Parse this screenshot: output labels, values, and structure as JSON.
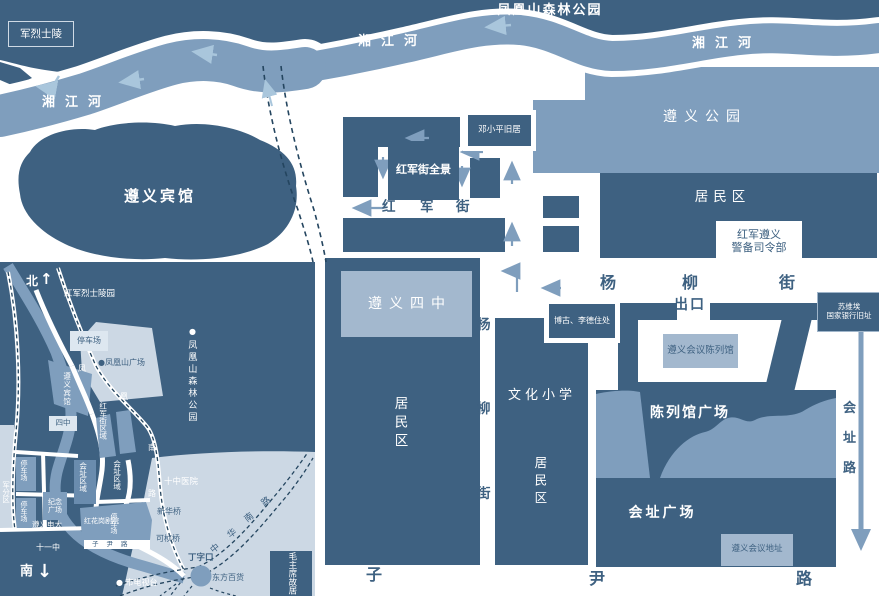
{
  "colors": {
    "dark": "#3e6181",
    "medium": "#7f9ebd",
    "pale": "#ccd8e4",
    "box_light": "#a3b8ce",
    "box_pale": "#dde7f0",
    "arrow_light": "#a9c6dc",
    "dash": "#24455f",
    "white": "#ffffff"
  },
  "main": {
    "park_title": "凤凰山森林公园",
    "martyrs_tomb": "军烈士陵",
    "river": "湘江河",
    "hotel": "遵义宾馆",
    "zunyi_park": "遵义公园",
    "residential": "居民区",
    "hq_line1": "红军遵义",
    "hq_line2": "警备司令部",
    "deng_residence": "邓小平旧居",
    "hjj_panorama": "红军街全景",
    "hongjun_street": [
      "红",
      "军",
      "街"
    ],
    "yangliu_street_h": [
      "杨",
      "柳",
      "街"
    ],
    "yangliu_street_v": [
      "杨",
      "柳",
      "街"
    ],
    "sizhong": "遵义四中",
    "residential_v1": "居民区",
    "wenhua_school": "文化小学",
    "residential_v2": "居民区",
    "bogu_lide": "博古、李德住处",
    "exit": "出口",
    "bank_line1": "苏维埃",
    "bank_line2": "国家银行旧址",
    "museum": "遵义会议陈列馆",
    "museum_square": "陈列馆广场",
    "site_square": "会址广场",
    "site_address": "遵义会议地址",
    "huizhi_road": [
      "会",
      "址",
      "路"
    ],
    "ziyin_road": [
      "子",
      "尹",
      "路"
    ]
  },
  "inset": {
    "north": "北",
    "north_arrow": "↑",
    "south": "南",
    "south_arrow": "↓",
    "martyrs_cemetery": "红军烈士陵园",
    "parking": "停车场",
    "fhs_square": "●凤凰山广场",
    "bullet": "●",
    "fhs_park": "凤凰山森林公园",
    "hotel": "遵义宾馆",
    "fenghuang_road": [
      "凤",
      "凰",
      "南",
      "路"
    ],
    "sizhong": "四中",
    "hjj_region": "红军街区域",
    "site_region1": "会址区域",
    "site_region2": "会址区域",
    "junfenqu": "军分区",
    "jinian_line1": "纪念",
    "jinian_line2": "广场",
    "dianda": "遵义电大",
    "shiyizhong": "十一中",
    "hospital": "十中医院",
    "theater": "红花岗剧院",
    "ziyin_strip": "子尹路",
    "xinhua_bridge": "新华桥",
    "kezhen_bridge": "可桢桥",
    "dingzikou": "丁字口",
    "dongfang_store": "东方百货",
    "zhonghua_road": [
      "中",
      "华",
      "南",
      "路"
    ],
    "tv_station": "● 市电视台",
    "mao_residence": "毛主席故居"
  }
}
